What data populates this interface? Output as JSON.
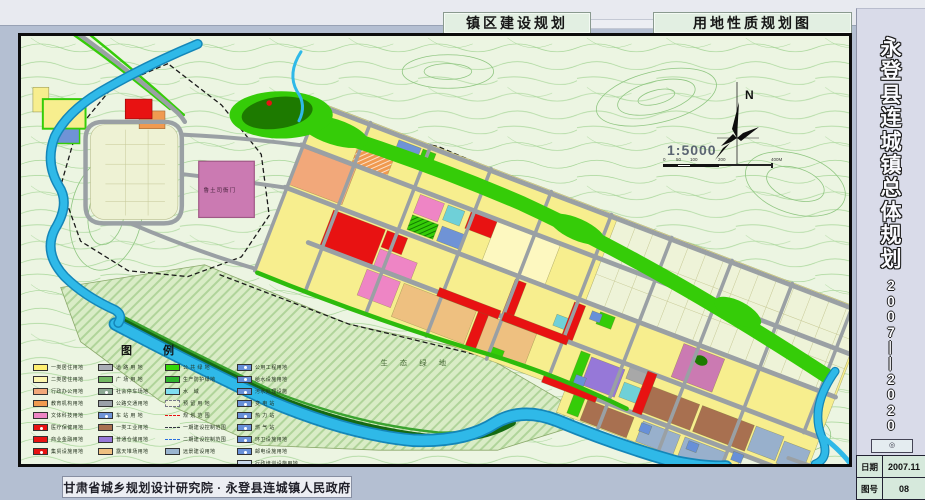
{
  "header": {
    "left_title": "镇区建设规划",
    "right_title": "用地性质规划图"
  },
  "sidebar": {
    "title_chars": [
      "永",
      "登",
      "县",
      "连",
      "城",
      "镇",
      "总",
      "体",
      "规",
      "划"
    ],
    "period_chars": [
      "2",
      "0",
      "0",
      "7",
      "—",
      "—",
      "2",
      "0",
      "2",
      "0"
    ],
    "ornament": "◎",
    "info_rows": [
      {
        "label": "日期",
        "value": "2007.11"
      },
      {
        "label": "图号",
        "value": "08"
      }
    ]
  },
  "footer": {
    "credit": "甘肃省城乡规划设计研究院 · 永登县连城镇人民政府"
  },
  "map": {
    "labels": {
      "heritage_site": "鲁土司衙门",
      "eco_green": "生 态 绿 地",
      "north": "N",
      "scale": "1:5000"
    },
    "scale_ticks": [
      "0",
      "50",
      "100",
      "200",
      "400M"
    ]
  },
  "legend": {
    "title": "图  例",
    "columns": [
      {
        "items": [
          {
            "label": "一类居住用地",
            "color": "#ffef70",
            "type": "swatch"
          },
          {
            "label": "二类居住用地",
            "color": "#fcf6ae",
            "type": "swatch"
          },
          {
            "label": "行政办公用地",
            "color": "#f2a87a",
            "type": "swatch"
          },
          {
            "label": "教育机构用地",
            "color": "#f09a50",
            "type": "swatch"
          },
          {
            "label": "文体科技用地",
            "color": "#ee85c5",
            "type": "swatch"
          },
          {
            "label": "医疗保健用地",
            "color": "#e81212",
            "type": "swatch",
            "dot": true
          },
          {
            "label": "商业金融用地",
            "color": "#e81212",
            "type": "swatch"
          },
          {
            "label": "集贸设施用地",
            "color": "#e81212",
            "type": "swatch",
            "dot": true
          }
        ]
      },
      {
        "items": [
          {
            "label": "道 路 用 地",
            "color": "#a9adb5",
            "type": "swatch"
          },
          {
            "label": "广 场 用 地",
            "color": "#72b862",
            "type": "swatch"
          },
          {
            "label": "社会停车场地",
            "color": "#8ca893",
            "type": "swatch",
            "dot": true
          },
          {
            "label": "公路交通用地",
            "color": "#9aa0a8",
            "type": "swatch"
          },
          {
            "label": "车 站 用 地",
            "color": "#6f93d6",
            "type": "swatch",
            "dot": true
          },
          {
            "label": "一类工业用地",
            "color": "#a87050",
            "type": "swatch"
          },
          {
            "label": "普通仓储用地",
            "color": "#9678d8",
            "type": "swatch"
          },
          {
            "label": "露天堆场用地",
            "color": "#eec080",
            "type": "swatch"
          }
        ]
      },
      {
        "items": [
          {
            "label": "公 共 绿 地",
            "color": "#35d607",
            "type": "swatch"
          },
          {
            "label": "生产防护绿地",
            "color": "#2cb32c",
            "type": "swatch"
          },
          {
            "label": "水　域",
            "color": "#7fdef0",
            "type": "swatch"
          },
          {
            "label": "预 留 用 地",
            "color": "#eef4da",
            "type": "swatch",
            "outline": "dashed"
          },
          {
            "label": "规 划 范 围",
            "color": "#e81212",
            "type": "dash"
          },
          {
            "label": "一期建设控制范围",
            "color": "#333344",
            "type": "dash"
          },
          {
            "label": "二期建设控制范围",
            "color": "#2a6fe0",
            "type": "dash"
          },
          {
            "label": "远景建设用地",
            "color": "#9ab4cf",
            "type": "swatch"
          }
        ]
      },
      {
        "items": [
          {
            "label": "公用工程用地",
            "color": "#6890d8",
            "type": "swatch",
            "dot": true
          },
          {
            "label": "给水设施用地",
            "color": "#6890d8",
            "type": "swatch",
            "dot": true
          },
          {
            "label": "污水处理设施",
            "color": "#6890d8",
            "type": "swatch",
            "dot": true
          },
          {
            "label": "变 电 站",
            "color": "#6890d8",
            "type": "swatch",
            "dot": true
          },
          {
            "label": "热 力 站",
            "color": "#6890d8",
            "type": "swatch",
            "dot": true
          },
          {
            "label": "燃 气 站",
            "color": "#6890d8",
            "type": "swatch",
            "dot": true
          },
          {
            "label": "环卫设施用地",
            "color": "#6890d8",
            "type": "swatch",
            "dot": true
          },
          {
            "label": "邮电设施用地",
            "color": "#6890d8",
            "type": "swatch",
            "dot": true
          },
          {
            "label": "行政培训设施用地",
            "color": "#c9d9ec",
            "type": "swatch"
          }
        ]
      }
    ]
  },
  "palette": {
    "topoBg": "#ecf5e2",
    "contour": "#a5d596",
    "contour2": "#8fc681",
    "water": "#2fb9e8",
    "waterEdge": "#1486b8",
    "road": "#9aa0a4",
    "yellow": "#f7ee8e",
    "paleYellow": "#fdf8c0",
    "reserve": "#eef3d8",
    "orange": "#f09a50",
    "salmon": "#f2a87a",
    "pink": "#ee85c5",
    "mauve": "#cb7ab2",
    "red": "#e81212",
    "green": "#35cc08",
    "green2": "#2dbb0c",
    "darkGreen": "#156a12",
    "parkDark": "#1d7a00",
    "teal": "#6fd0d8",
    "blue": "#6f93d6",
    "purple": "#9678d8",
    "brown": "#a87050",
    "tan": "#eec080",
    "gray": "#a8a8a8",
    "blueGray": "#98b0cc",
    "util": "#6890d8",
    "ecoBg": "#d9ecc6",
    "ecoHatch": "#b0d49a"
  }
}
